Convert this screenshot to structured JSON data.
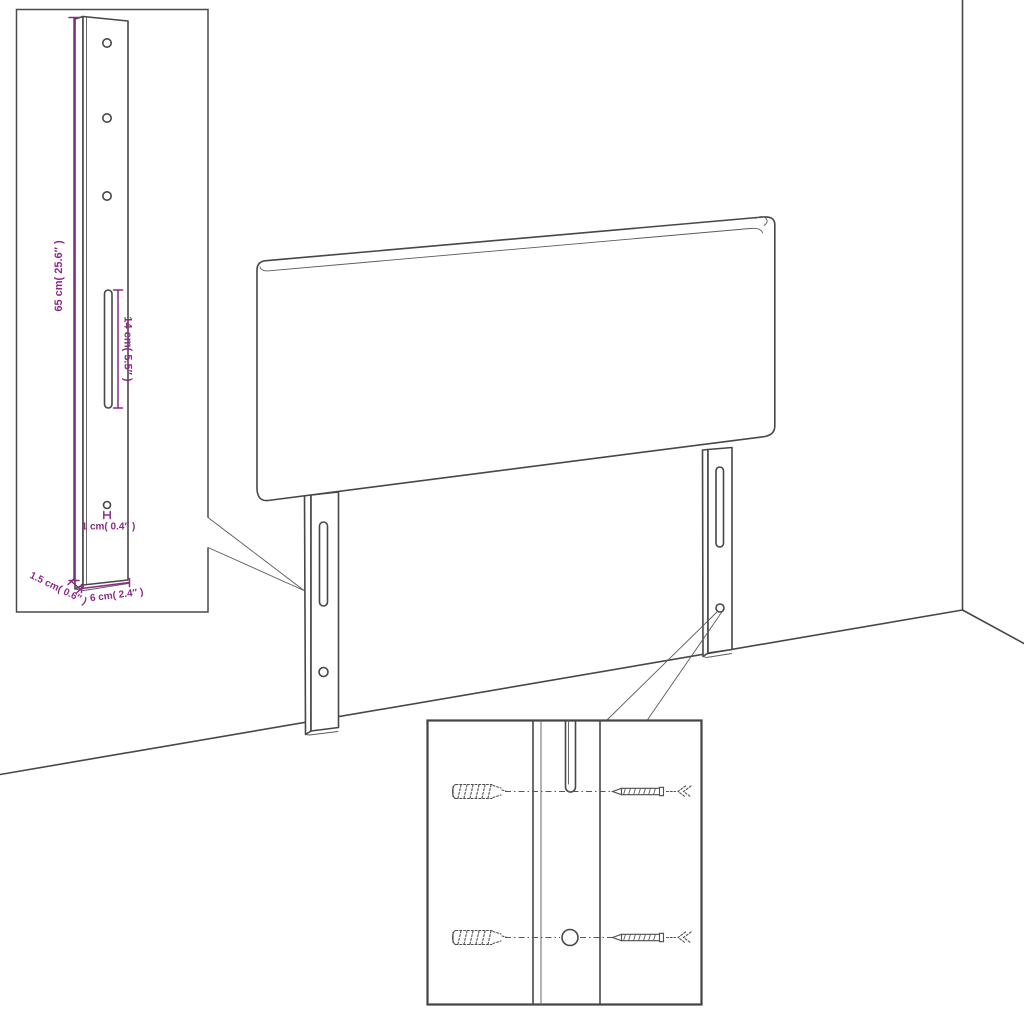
{
  "diagram": {
    "subject": "headboard-with-legs-assembly-diagram",
    "colors": {
      "accent": "#8b2a87",
      "line": "#474747"
    },
    "leg_detail_inset": {
      "height_label": "65 cm( 25.6″ )",
      "slot_label": "14 cm( 5.5″ )",
      "hole_label": "1 cm( 0.4″ )",
      "thickness_label": "1.5 cm( 0.6″ )",
      "width_label": "6 cm( 2.4″ )"
    }
  }
}
